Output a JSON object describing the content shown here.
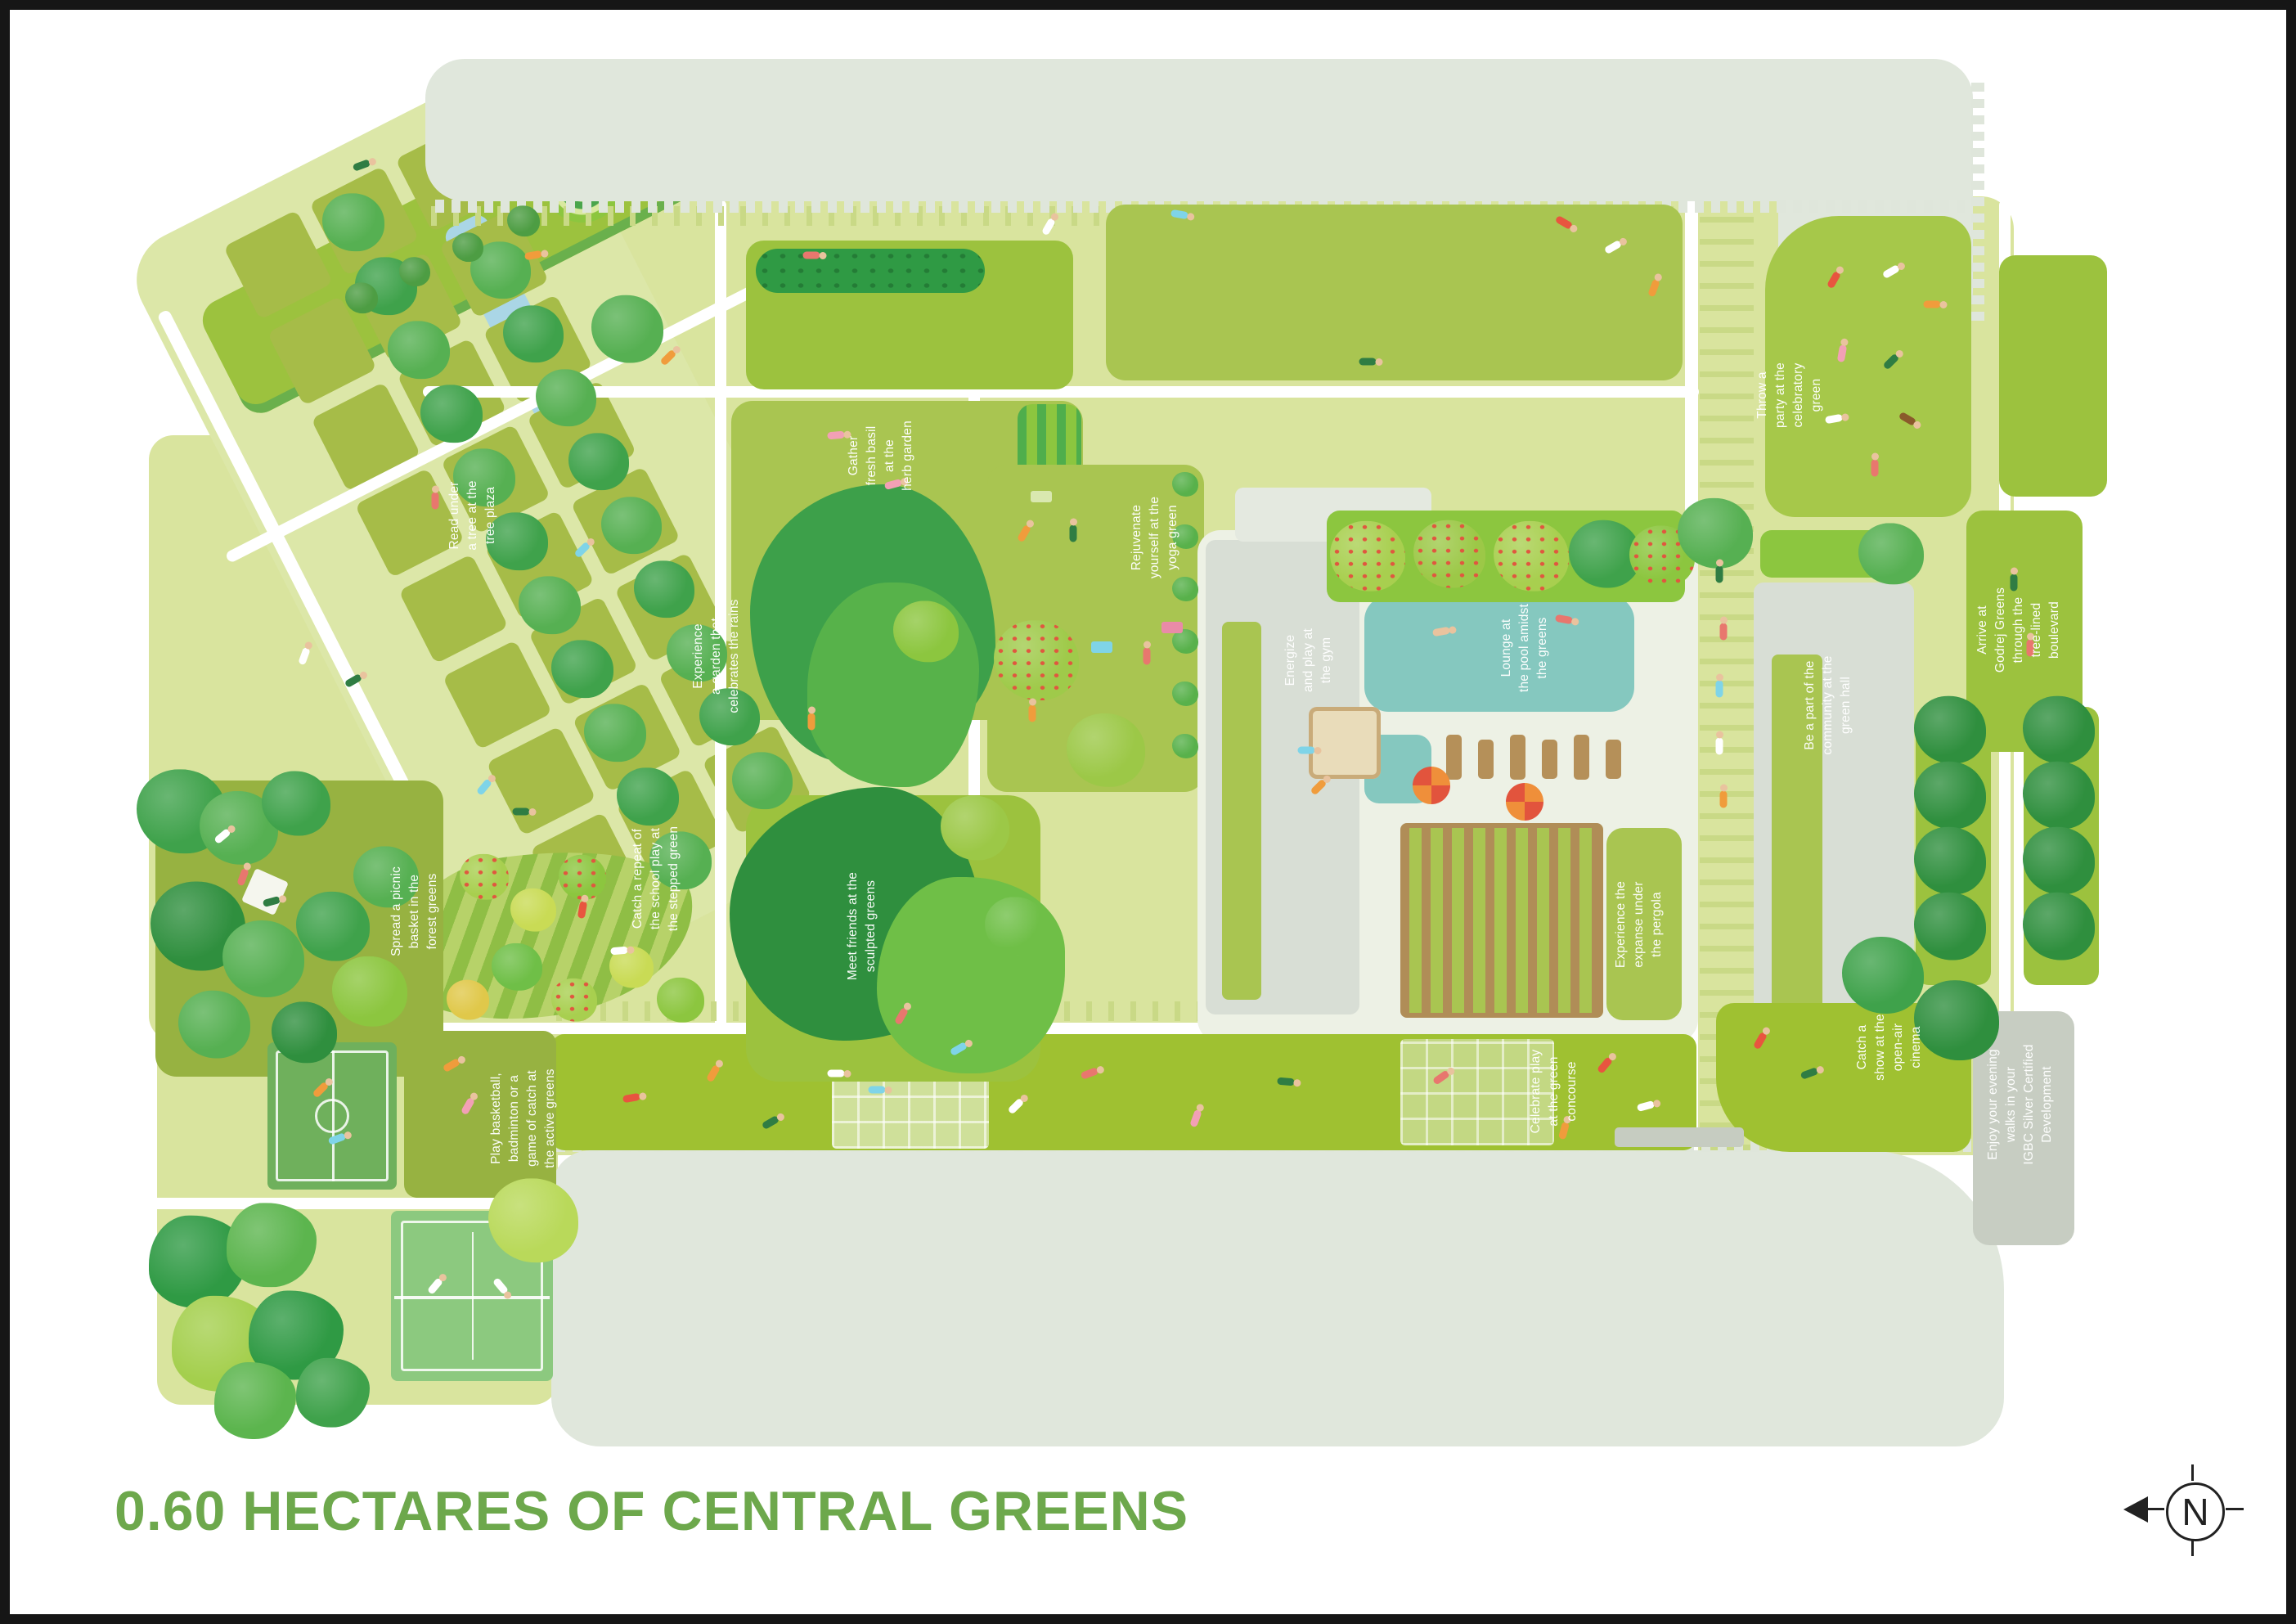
{
  "title": "0.60 HECTARES OF CENTRAL GREENS",
  "compass": {
    "letter": "N"
  },
  "labels": {
    "tree_plaza": "Read under\na tree at the\ntree plaza",
    "herb_garden": "Gather\nfresh basil\nat the\nherb garden",
    "rain_garden": "Experience\na garden that\ncelebrates the rains",
    "yoga_green": "Rejuvenate\nyourself at the\nyoga green",
    "gym": "Energize\nand play at\nthe gym",
    "pool": "Lounge at\nthe pool amidst\nthe greens",
    "stepped_green": "Catch a repeat of\nthe school play at\nthe stepped green",
    "sculpted_greens": "Meet friends at the\nsculpted greens",
    "forest_greens": "Spread a picnic\nbasket in the\nforest greens",
    "active_greens": "Play basketball,\nbadminton or a\ngame of catch at\nthe active greens",
    "pergola": "Experience the\nexpanse under\nthe pergola",
    "green_concourse": "Celebrate play\nat the green\nconcourse",
    "open_air_cinema": "Catch a\nshow at the\nopen-air\ncinema",
    "celebratory_green": "Throw a\nparty at the\ncelebratory\ngreen",
    "green_hall": "Be a part of the\ncommunity at the\ngreen hall",
    "boulevard": "Arrive at\nGodrej Greens\nthrough the\ntree-lined\nboulevard",
    "igbc": "Enjoy your evening\nwalks in your\nIGBC Silver Certified\nDevelopment"
  },
  "colors": {
    "title_green": "#6da84c",
    "pool_teal": "#85c8bf",
    "lawn_green": "#a9c551",
    "bright_lawn": "#9fc131",
    "olive_green": "#97b241",
    "park_base": "#d9e49e",
    "building_gray": "#e0e7dc",
    "pergola_brown": "#b08d57",
    "umbrella_orange": "#ef8f3a"
  }
}
